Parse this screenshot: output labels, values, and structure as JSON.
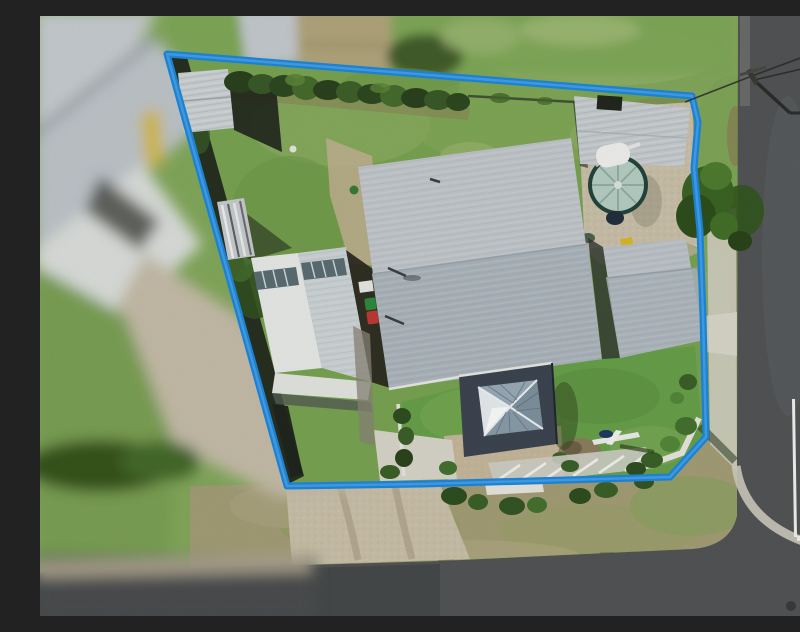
{
  "scene": {
    "type": "aerial-drone-property-photo",
    "aria_label": "Aerial drone photograph of a corner residential property outlined with a blue boundary line, showing a large grey metal roof house, carport, shed, round rainwater tank, lawns, gravel driveway and two intersecting roads"
  },
  "palette": {
    "boundary_blue": "#1e88dd",
    "boundary_highlight": "#4aa3ea",
    "lawn_back": "#7aa452",
    "lawn_front": "#68a14a",
    "grass_outside": "#84a95c",
    "verge_brown": "#a49e77",
    "road": "#525456",
    "road_dark": "#454749",
    "gravel": "#cbc1aa",
    "concrete": "#d9d6ca",
    "footpath": "#d3cfc2",
    "kerb": "#cfccc0",
    "roof_light": "#c3c8cc",
    "roof_shade": "#adb6bd",
    "wing_roof": "#bdc4c9",
    "carport_white": "#e9ebe8",
    "carport_grey": "#cdd4d6",
    "awning_white": "#e4e6e2",
    "shed_roof": "#c7cccf",
    "small_shed_roof": "#ccd1d3",
    "tank_dome": "#b7cfc5",
    "tank_rim": "#24453c",
    "tank_rib": "#8fa89e",
    "pavilion_dark": "#3d4551",
    "glass": "#9aacb8",
    "glass_bright": "#e8edf0",
    "hedge_dark": "#2f4723",
    "bush_green": "#467231",
    "paver_tan": "#c7b89b",
    "neighbor_tan": "#b2a67d",
    "neighbor_roof": "#c6cbd0",
    "shadow_dark": "#20261d",
    "dirt": "#8d7c57",
    "bin_green": "#2e8b3d",
    "bin_red": "#c03a35",
    "yellow_box": "#d8b92c",
    "white_line": "#f2f2ee",
    "wire": "#2b2b28"
  }
}
